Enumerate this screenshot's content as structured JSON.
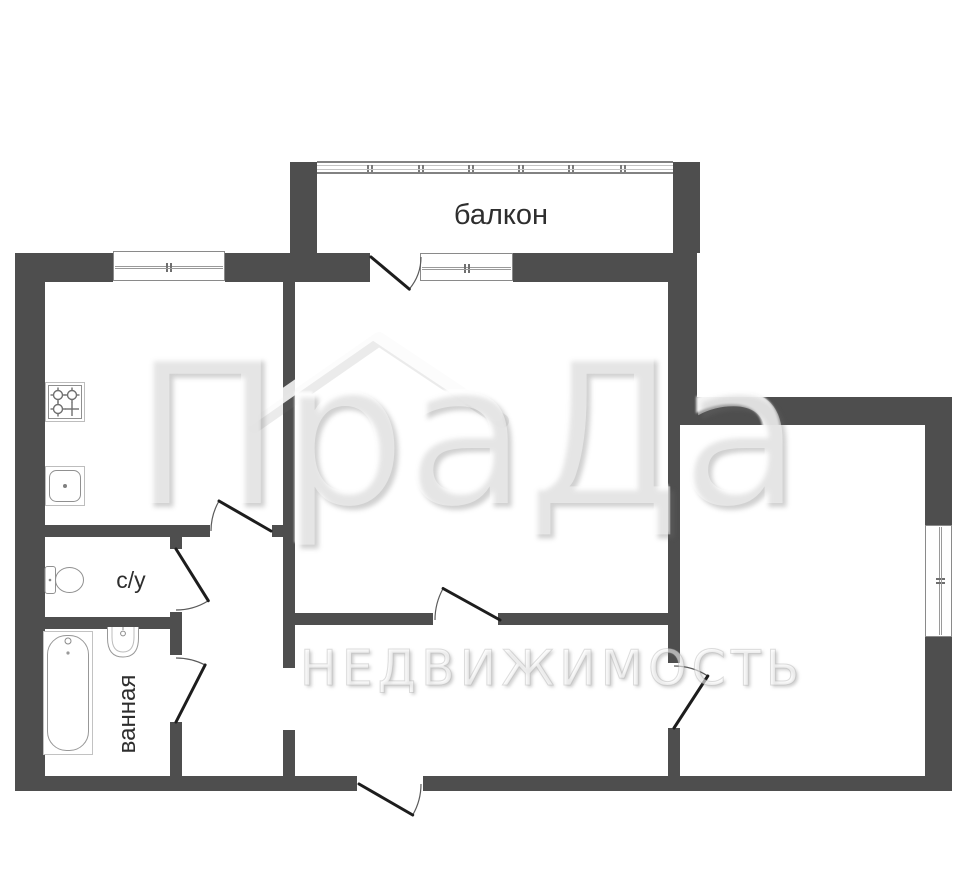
{
  "labels": {
    "balcony": "балкон",
    "toilet": "с/у",
    "bathroom": "ванная"
  },
  "watermark": {
    "title": "ПраДа",
    "subtitle": "НЕДВИЖИМОСТЬ"
  },
  "colors": {
    "wall": "#4e4e4e",
    "door_leaf": "#1d1d1d",
    "door_arc": "#5a5a5a",
    "fixture_outline": "#949494",
    "window_frame": "#8a8a8a",
    "label_text": "#2e2e2e"
  },
  "plan": {
    "walls": [
      [
        15,
        253,
        98,
        29
      ],
      [
        225,
        253,
        145,
        29
      ],
      [
        513,
        253,
        184,
        29
      ],
      [
        15,
        253,
        30,
        538
      ],
      [
        15,
        776,
        342,
        15
      ],
      [
        423,
        776,
        529,
        15
      ],
      [
        925,
        397,
        27,
        128
      ],
      [
        925,
        637,
        27,
        154
      ],
      [
        668,
        397,
        284,
        28
      ],
      [
        668,
        253,
        29,
        144
      ],
      [
        668,
        425,
        12,
        238
      ],
      [
        668,
        728,
        12,
        48
      ],
      [
        283,
        282,
        12,
        386
      ],
      [
        283,
        730,
        12,
        46
      ],
      [
        45,
        525,
        165,
        12
      ],
      [
        272,
        525,
        23,
        12
      ],
      [
        45,
        617,
        137,
        12
      ],
      [
        170,
        537,
        12,
        12
      ],
      [
        170,
        612,
        12,
        43
      ],
      [
        170,
        722,
        12,
        54
      ],
      [
        290,
        162,
        27,
        91
      ],
      [
        673,
        162,
        27,
        91
      ],
      [
        295,
        613,
        138,
        12
      ],
      [
        498,
        613,
        170,
        12
      ]
    ],
    "windows": [
      {
        "x": 113,
        "y": 251,
        "w": 112,
        "h": 30,
        "o": "h"
      },
      {
        "x": 420,
        "y": 253,
        "w": 93,
        "h": 28,
        "o": "h"
      },
      {
        "x": 925,
        "y": 525,
        "w": 27,
        "h": 112,
        "o": "v"
      }
    ],
    "balcony_band": {
      "x": 317,
      "y": 161,
      "w": 356,
      "h": 13,
      "ticks": [
        0.14,
        0.285,
        0.425,
        0.565,
        0.705,
        0.85
      ]
    },
    "doors": [
      {
        "name": "balcony-door",
        "hx": 371,
        "hy": 257,
        "r": 50,
        "leaf": 40,
        "closed": 0
      },
      {
        "name": "kitchen-door",
        "hx": 271,
        "hy": 531,
        "r": 60,
        "leaf": 210,
        "closed": 180
      },
      {
        "name": "toilet-door",
        "hx": 176,
        "hy": 549,
        "r": 61,
        "leaf": 58,
        "closed": 90
      },
      {
        "name": "bathroom-door",
        "hx": 176,
        "hy": 722,
        "r": 64,
        "leaf": -63,
        "closed": -90
      },
      {
        "name": "living-room-door",
        "hx": 500,
        "hy": 620,
        "r": 65,
        "leaf": 209,
        "closed": 180
      },
      {
        "name": "bedroom-door",
        "hx": 674,
        "hy": 728,
        "r": 62,
        "leaf": -57,
        "closed": -90
      },
      {
        "name": "entrance-door",
        "hx": 359,
        "hy": 784,
        "r": 62,
        "leaf": 30,
        "closed": 0
      }
    ]
  }
}
